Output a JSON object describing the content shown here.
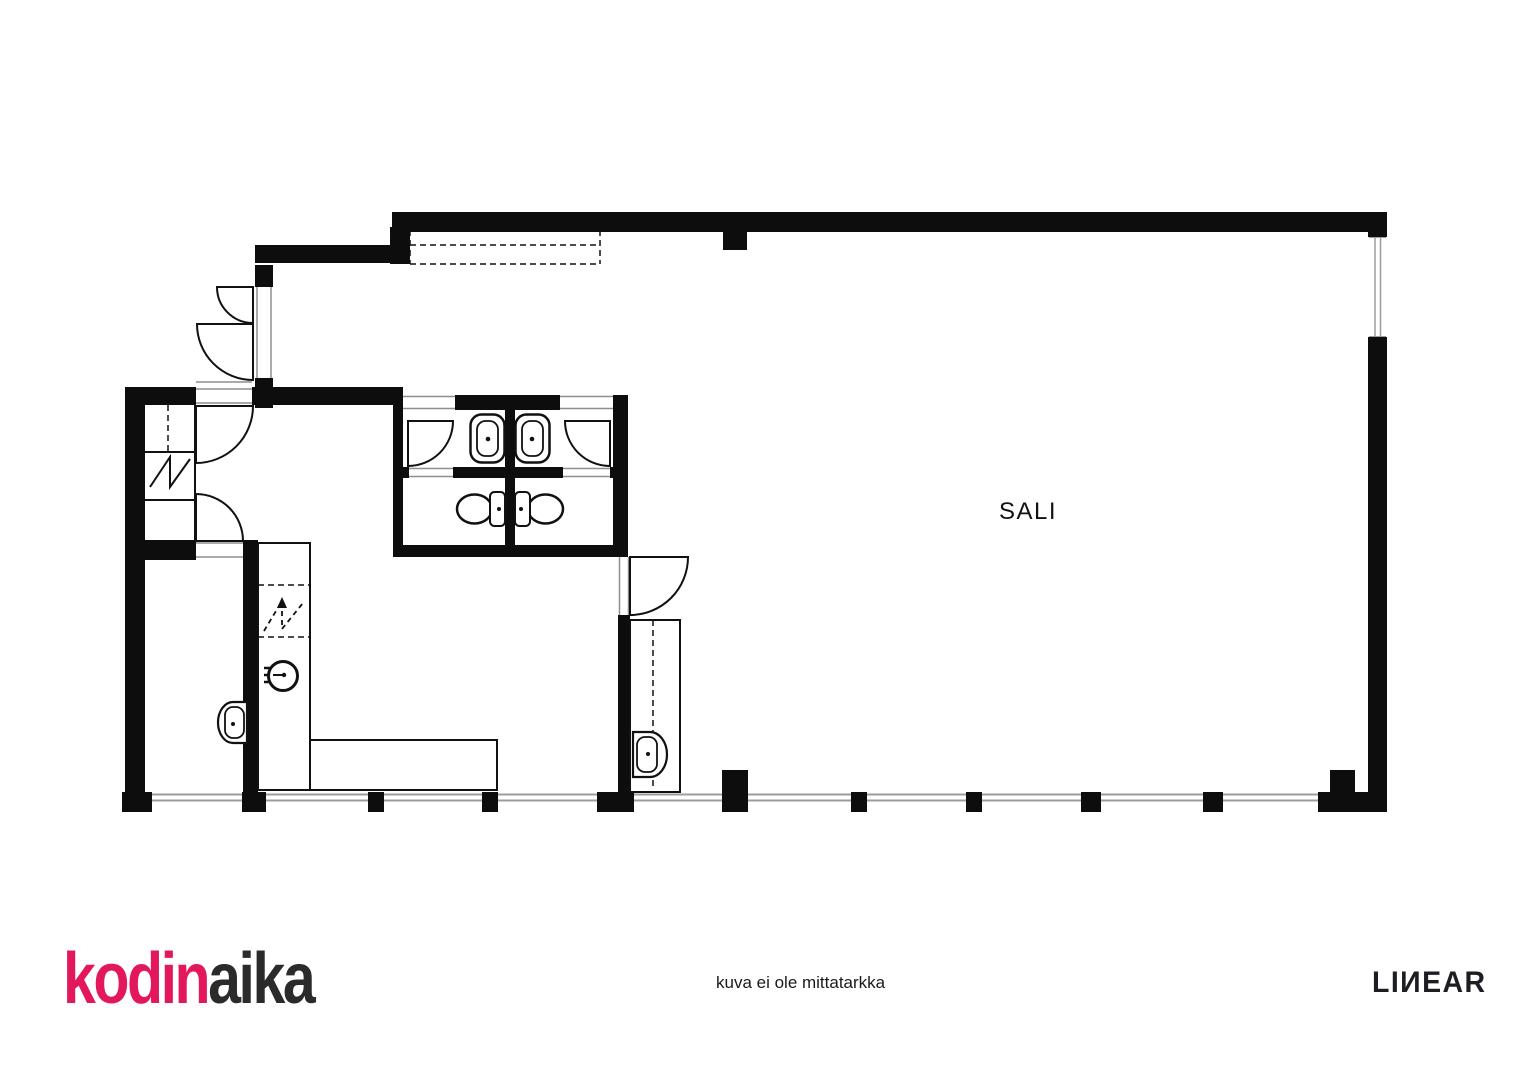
{
  "plan": {
    "room_label": "SALI",
    "colors": {
      "wall": "#0d0d0d",
      "line": "#111111",
      "window_gray": "#9c9c9c",
      "threshold_gray": "#8e8e8e"
    },
    "symbols": [
      "door-swing",
      "window",
      "wc-sink",
      "toilet",
      "washbasin",
      "stove",
      "wardrobe-dashed-box",
      "electrical-zigzag"
    ]
  },
  "footer": {
    "logo": {
      "text_primary": "kodin",
      "text_secondary": "aika",
      "primary_color": "#e3175c",
      "secondary_color": "#2b2b2b"
    },
    "disclaimer": "kuva ei ole mittatarkka",
    "partner_logo": "LIИEAR"
  }
}
